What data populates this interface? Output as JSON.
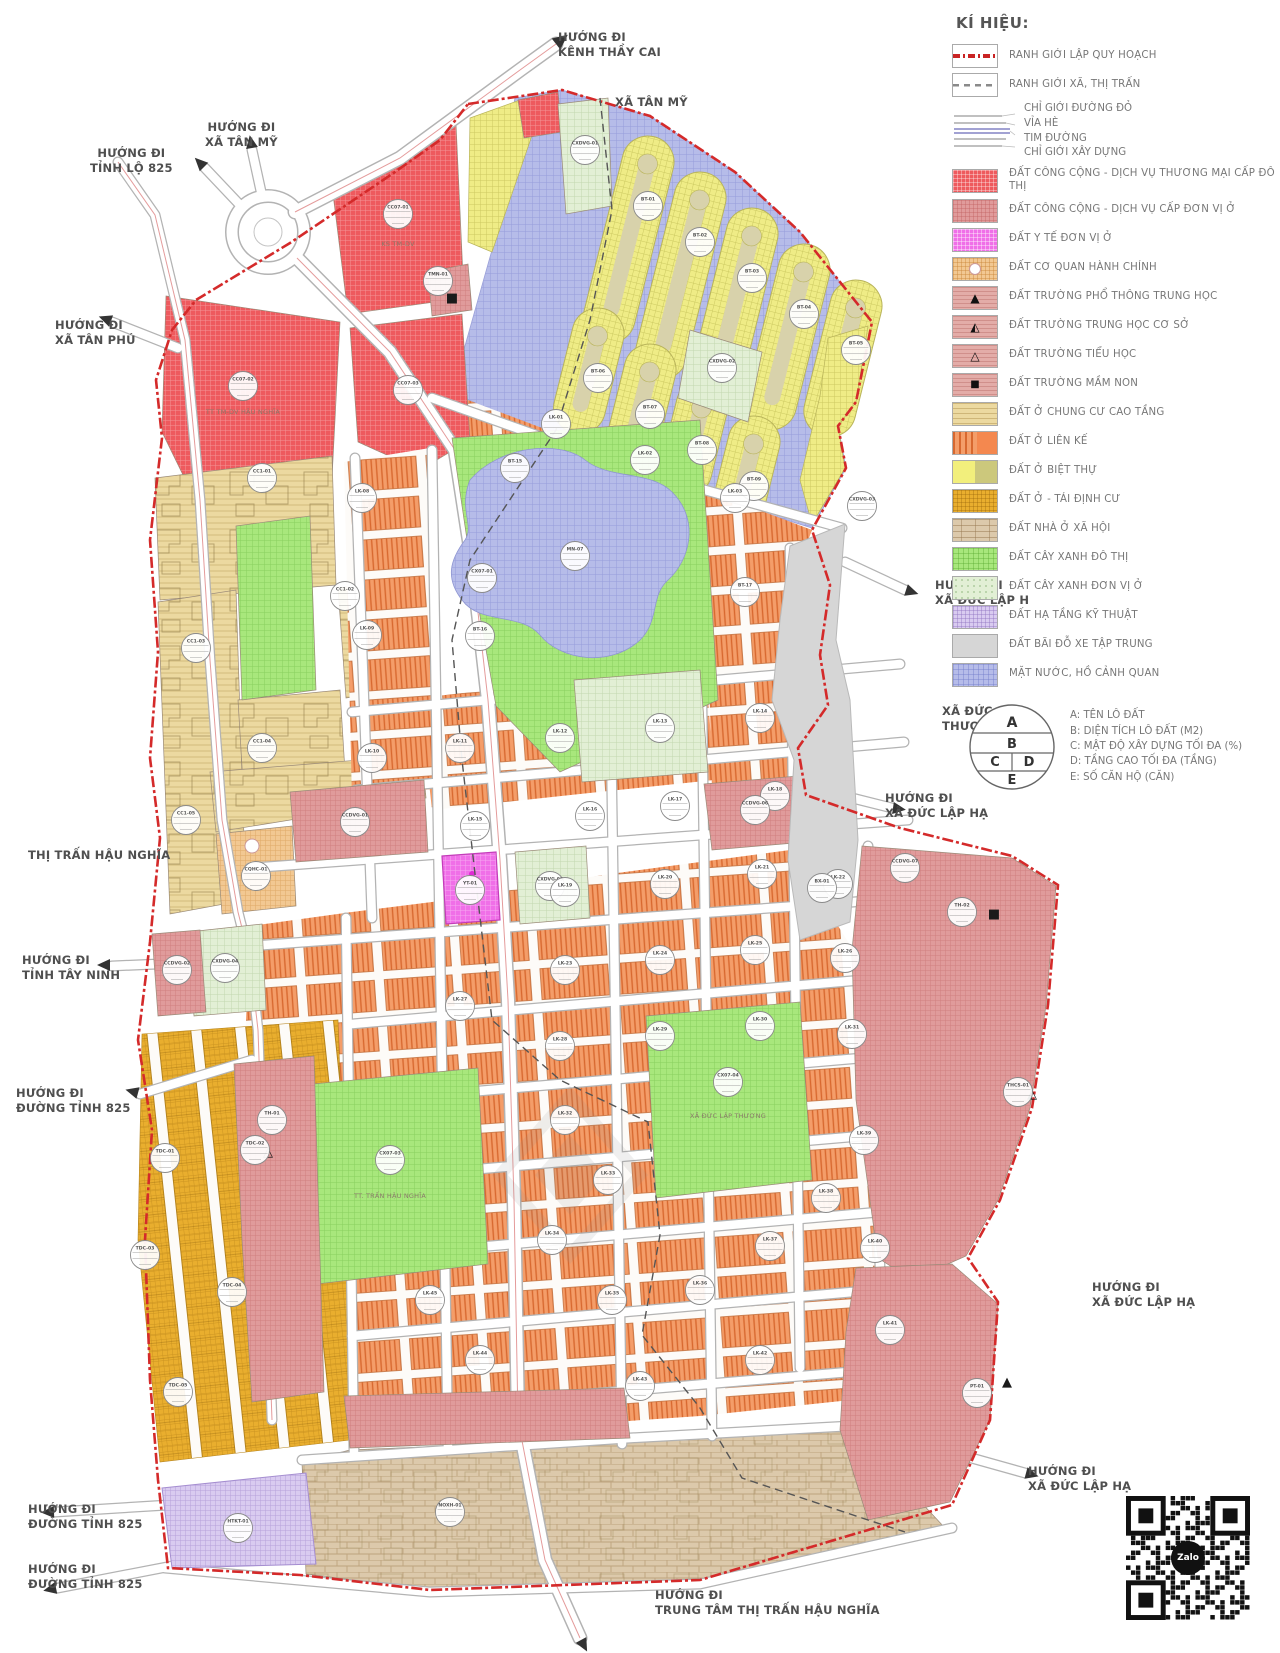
{
  "legend": {
    "title": "KÍ HIỆU:",
    "boundary_items": [
      {
        "label": "RANH GIỚI LẬP QUY HOẠCH",
        "color": "#c92323"
      },
      {
        "label": "RANH GIỚI XÃ, THỊ TRẤN",
        "color": "#8a8a8a"
      }
    ],
    "road_section": {
      "labels": [
        "CHỈ GIỚI ĐƯỜNG ĐỎ",
        "VỈA HÈ",
        "TIM ĐƯỜNG",
        "CHỈ GIỚI XÂY DỰNG"
      ]
    },
    "items": [
      {
        "label": "ĐẤT CÔNG CỘNG - DỊCH VỤ THƯƠNG MẠI CẤP ĐÔ THỊ",
        "color": "#ee5a5e"
      },
      {
        "label": "ĐẤT CÔNG CỘNG - DỊCH VỤ CẤP ĐƠN VỊ Ở",
        "color": "#e09b9b"
      },
      {
        "label": "ĐẤT Y TẾ ĐƠN VỊ Ở",
        "color": "#f06fe8"
      },
      {
        "label": "ĐẤT CƠ QUAN HÀNH CHÍNH",
        "color": "#f2c892"
      },
      {
        "label": "ĐẤT TRƯỜNG PHỔ THÔNG TRUNG HỌC",
        "color": "#e3aca8"
      },
      {
        "label": "ĐẤT TRƯỜNG TRUNG HỌC CƠ SỞ",
        "color": "#e3aca8"
      },
      {
        "label": "ĐẤT TRƯỜNG TIỂU HỌC",
        "color": "#e3aca8"
      },
      {
        "label": "ĐẤT TRƯỜNG MẦM NON",
        "color": "#e3aca8"
      },
      {
        "label": "ĐẤT Ở CHUNG CƯ CAO TẦNG",
        "color": "#ecd9a0"
      },
      {
        "label": "ĐẤT Ở LIÊN KẾ",
        "color": "#f4884f"
      },
      {
        "label": "ĐẤT Ở BIỆT THỰ",
        "color": "#f2ef7c"
      },
      {
        "label": "ĐẤT Ở - TÁI ĐỊNH CƯ",
        "color": "#e9ae2e"
      },
      {
        "label": "ĐẤT NHÀ Ở XÃ HỘI",
        "color": "#dcc9ab"
      },
      {
        "label": "ĐẤT CÂY XANH ĐÔ THỊ",
        "color": "#a8e77c"
      },
      {
        "label": "ĐẤT CÂY XANH ĐƠN VỊ Ở",
        "color": "#e2efd5"
      },
      {
        "label": "ĐẤT HẠ TẦNG KỸ THUẬT",
        "color": "#d9cbf0"
      },
      {
        "label": "ĐẤT BÃI ĐỖ XE TẬP TRUNG",
        "color": "#d6d6d6"
      },
      {
        "label": "MẶT NƯỚC, HỒ CẢNH QUAN",
        "color": "#b6bce9"
      }
    ],
    "plot_key": {
      "letters": [
        "A",
        "B",
        "C",
        "D",
        "E"
      ],
      "notes": [
        "A: TÊN LÔ ĐẤT",
        "B: DIỆN TÍCH LÔ ĐẤT (M2)",
        "C: MẬT ĐỘ XÂY DỰNG TỐI ĐA (%)",
        "D: TẦNG CAO TỐI ĐA (TẦNG)",
        "E: SỐ CĂN HỘ (CĂN)"
      ]
    }
  },
  "map": {
    "labels": {
      "kenh_thay_cai": "HƯỚNG ĐI\nKÊNH THẦY CAI",
      "xa_tan_my": "XÃ TÂN MỸ",
      "di_xa_tan_my": "HƯỚNG ĐI\nXÃ TÂN MỸ",
      "tinh_lo_825": "HƯỚNG ĐI\nTỈNH LỘ 825",
      "xa_tan_phu": "HƯỚNG ĐI\nXÃ TÂN PHÚ",
      "thi_tran_hau_nghia": "THỊ TRẤN HẬU NGHĨA",
      "tinh_tay_ninh": "HƯỚNG ĐI\nTỈNH TÂY NINH",
      "duong_tinh_825_a": "HƯỚNG ĐI\nĐƯỜNG TỈNH 825",
      "duong_tinh_825_b": "HƯỚNG ĐI\nĐƯỜNG TỈNH 825",
      "duong_tinh_825_c": "HƯỚNG ĐI\nĐƯỜNG TỈNH 825",
      "trung_tam": "HƯỚNG ĐI\nTRUNG TÂM THỊ TRẤN HẬU NGHĨA",
      "xdlh_1": "HƯỚNG ĐI\nXÃ ĐỨC LẬP H",
      "xdlh_2": "HƯỚNG ĐI\nXÃ ĐỨC LẬP HẠ",
      "xdlh_3": "HƯỚNG ĐI\nXÃ ĐỨC LẬP HẠ",
      "xdlh_4": "HƯỚNG ĐI\nXÃ ĐỨC LẬP HẠ",
      "xa_duc_la_thuong": "XÃ ĐỨC LẠ\nTHƯỢNG",
      "sub_ks": "KS TM-DV",
      "sub_tttm": "TT TM-DV HẬU NGHĨA",
      "sub_tthn": "TT. TRẤN HẬU NGHĨA",
      "sub_xdlt": "XÃ ĐỨC LẬP THƯỢNG"
    },
    "plots": [
      {
        "n": "CC07-01",
        "x": 398,
        "y": 214
      },
      {
        "n": "CC07-02",
        "x": 243,
        "y": 386
      },
      {
        "n": "CC07-03",
        "x": 408,
        "y": 390
      },
      {
        "n": "TMN-01",
        "x": 438,
        "y": 281
      },
      {
        "n": "CXDVG-01",
        "x": 585,
        "y": 150
      },
      {
        "n": "BT-01",
        "x": 648,
        "y": 206
      },
      {
        "n": "BT-02",
        "x": 700,
        "y": 242
      },
      {
        "n": "BT-03",
        "x": 752,
        "y": 278
      },
      {
        "n": "BT-04",
        "x": 804,
        "y": 314
      },
      {
        "n": "BT-05",
        "x": 856,
        "y": 350
      },
      {
        "n": "BT-06",
        "x": 598,
        "y": 378
      },
      {
        "n": "BT-07",
        "x": 650,
        "y": 414
      },
      {
        "n": "BT-08",
        "x": 702,
        "y": 450
      },
      {
        "n": "BT-09",
        "x": 754,
        "y": 486
      },
      {
        "n": "CXDVG-02",
        "x": 722,
        "y": 368
      },
      {
        "n": "CXDVG-03",
        "x": 862,
        "y": 506
      },
      {
        "n": "LK-01",
        "x": 556,
        "y": 424
      },
      {
        "n": "LK-02",
        "x": 645,
        "y": 460
      },
      {
        "n": "LK-03",
        "x": 735,
        "y": 498
      },
      {
        "n": "BT-15",
        "x": 515,
        "y": 468
      },
      {
        "n": "MN-07",
        "x": 575,
        "y": 556
      },
      {
        "n": "CX07-01",
        "x": 482,
        "y": 578
      },
      {
        "n": "BT-16",
        "x": 480,
        "y": 636
      },
      {
        "n": "BT-17",
        "x": 745,
        "y": 592
      },
      {
        "n": "LK-08",
        "x": 362,
        "y": 498
      },
      {
        "n": "LK-09",
        "x": 367,
        "y": 635
      },
      {
        "n": "LK-10",
        "x": 372,
        "y": 758
      },
      {
        "n": "CC1-01",
        "x": 262,
        "y": 478
      },
      {
        "n": "CC1-02",
        "x": 345,
        "y": 596
      },
      {
        "n": "CC1-03",
        "x": 196,
        "y": 648
      },
      {
        "n": "CC1-04",
        "x": 262,
        "y": 748
      },
      {
        "n": "CC1-05",
        "x": 186,
        "y": 820
      },
      {
        "n": "CQHC-01",
        "x": 256,
        "y": 876
      },
      {
        "n": "CCDVG-01",
        "x": 355,
        "y": 822
      },
      {
        "n": "CXDVG-04",
        "x": 225,
        "y": 968
      },
      {
        "n": "CCDVG-02",
        "x": 177,
        "y": 970
      },
      {
        "n": "YT-01",
        "x": 470,
        "y": 890
      },
      {
        "n": "CXDVG-05",
        "x": 550,
        "y": 886
      },
      {
        "n": "LK-11",
        "x": 460,
        "y": 748
      },
      {
        "n": "LK-12",
        "x": 560,
        "y": 738
      },
      {
        "n": "LK-13",
        "x": 660,
        "y": 728
      },
      {
        "n": "LK-14",
        "x": 760,
        "y": 718
      },
      {
        "n": "LK-15",
        "x": 475,
        "y": 826
      },
      {
        "n": "LK-16",
        "x": 590,
        "y": 816
      },
      {
        "n": "LK-17",
        "x": 675,
        "y": 806
      },
      {
        "n": "LK-18",
        "x": 775,
        "y": 796
      },
      {
        "n": "LK-19",
        "x": 565,
        "y": 892
      },
      {
        "n": "LK-20",
        "x": 665,
        "y": 884
      },
      {
        "n": "LK-21",
        "x": 762,
        "y": 874
      },
      {
        "n": "LK-22",
        "x": 838,
        "y": 884
      },
      {
        "n": "LK-23",
        "x": 565,
        "y": 970
      },
      {
        "n": "LK-24",
        "x": 660,
        "y": 960
      },
      {
        "n": "LK-25",
        "x": 755,
        "y": 950
      },
      {
        "n": "LK-26",
        "x": 845,
        "y": 958
      },
      {
        "n": "LK-27",
        "x": 460,
        "y": 1006
      },
      {
        "n": "LK-28",
        "x": 560,
        "y": 1046
      },
      {
        "n": "LK-29",
        "x": 660,
        "y": 1036
      },
      {
        "n": "LK-30",
        "x": 760,
        "y": 1026
      },
      {
        "n": "LK-31",
        "x": 852,
        "y": 1034
      },
      {
        "n": "LK-32",
        "x": 565,
        "y": 1120
      },
      {
        "n": "LK-33",
        "x": 608,
        "y": 1180
      },
      {
        "n": "LK-34",
        "x": 552,
        "y": 1240
      },
      {
        "n": "LK-35",
        "x": 612,
        "y": 1300
      },
      {
        "n": "LK-36",
        "x": 700,
        "y": 1290
      },
      {
        "n": "LK-37",
        "x": 770,
        "y": 1246
      },
      {
        "n": "LK-38",
        "x": 826,
        "y": 1198
      },
      {
        "n": "LK-39",
        "x": 864,
        "y": 1140
      },
      {
        "n": "LK-40",
        "x": 875,
        "y": 1248
      },
      {
        "n": "LK-41",
        "x": 890,
        "y": 1330
      },
      {
        "n": "LK-42",
        "x": 760,
        "y": 1360
      },
      {
        "n": "LK-43",
        "x": 640,
        "y": 1386
      },
      {
        "n": "LK-44",
        "x": 480,
        "y": 1360
      },
      {
        "n": "LK-45",
        "x": 430,
        "y": 1300
      },
      {
        "n": "CX07-03",
        "x": 390,
        "y": 1160
      },
      {
        "n": "CX07-04",
        "x": 728,
        "y": 1082
      },
      {
        "n": "TH-01",
        "x": 272,
        "y": 1120
      },
      {
        "n": "TH-02",
        "x": 962,
        "y": 912
      },
      {
        "n": "THCS-01",
        "x": 1018,
        "y": 1092
      },
      {
        "n": "PT-01",
        "x": 977,
        "y": 1393
      },
      {
        "n": "BX-01",
        "x": 822,
        "y": 888
      },
      {
        "n": "TDC-01",
        "x": 165,
        "y": 1158
      },
      {
        "n": "TDC-02",
        "x": 255,
        "y": 1150
      },
      {
        "n": "TDC-03",
        "x": 145,
        "y": 1255
      },
      {
        "n": "TDC-04",
        "x": 232,
        "y": 1292
      },
      {
        "n": "TDC-05",
        "x": 178,
        "y": 1392
      },
      {
        "n": "NOXH-01",
        "x": 450,
        "y": 1512
      },
      {
        "n": "HTKT-01",
        "x": 238,
        "y": 1528
      },
      {
        "n": "CCDVG-06",
        "x": 755,
        "y": 810
      },
      {
        "n": "CCDVG-07",
        "x": 905,
        "y": 868
      }
    ],
    "glyphs": [
      {
        "ch": "▲",
        "x": 1007,
        "y": 1386
      },
      {
        "ch": "■",
        "x": 994,
        "y": 918
      },
      {
        "ch": "■",
        "x": 452,
        "y": 302
      },
      {
        "ch": "◭",
        "x": 1032,
        "y": 1098
      },
      {
        "ch": "△",
        "x": 268,
        "y": 1156
      }
    ]
  },
  "qr": {
    "brand": "Zalo"
  }
}
